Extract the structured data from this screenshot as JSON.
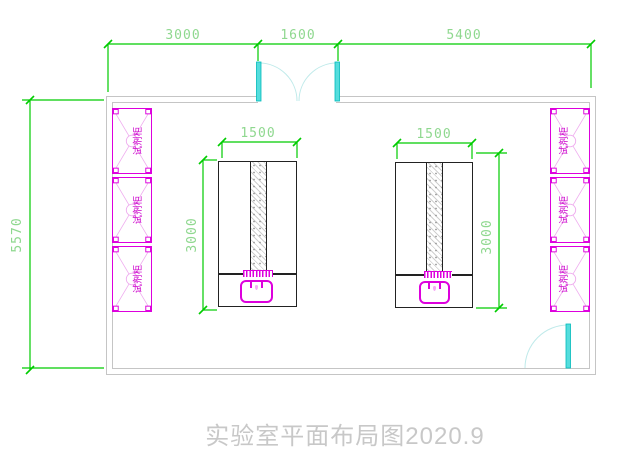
{
  "drawing": {
    "title": "实验室平面布局图2020.9",
    "dims": {
      "top_left": "3000",
      "top_middle": "1600",
      "top_right": "5400",
      "left_height": "5570",
      "bench_width": "1500",
      "bench_height": "3000"
    },
    "cabinet_label": "试剂柜",
    "colors": {
      "dimension_line": "#00cc00",
      "dimension_text": "#8fd88f",
      "cabinet": "#dd00dd",
      "door_leaf": "#55dddd",
      "door_arc": "#bfeaea",
      "wall": "#c5c5c5",
      "bench_outline": "#222222",
      "title_text": "#c8c8c8"
    }
  }
}
